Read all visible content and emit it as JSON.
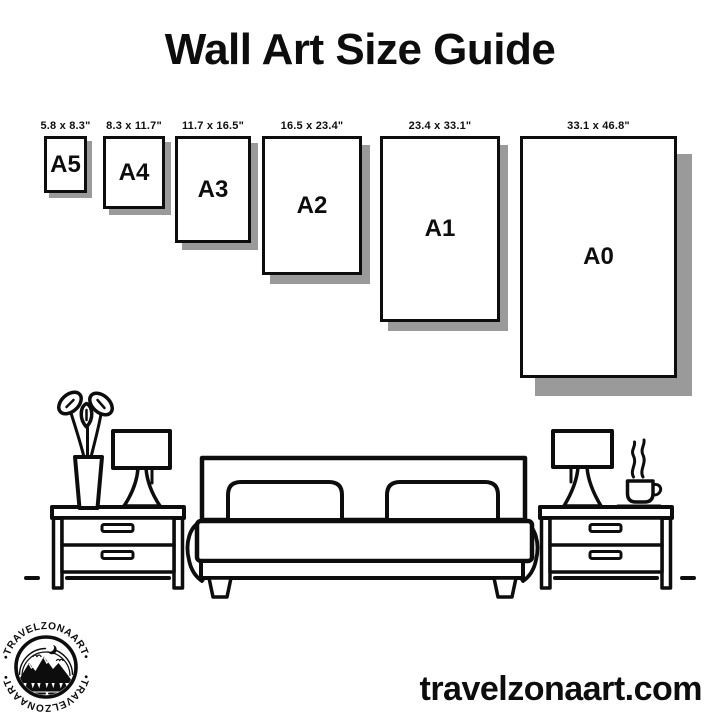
{
  "title": "Wall Art Size Guide",
  "papers": [
    {
      "code": "A5",
      "dims": "5.8 x 8.3\""
    },
    {
      "code": "A4",
      "dims": "8.3 x 11.7\""
    },
    {
      "code": "A3",
      "dims": "11.7 x 16.5\""
    },
    {
      "code": "A2",
      "dims": "16.5 x 23.4\""
    },
    {
      "code": "A1",
      "dims": "23.4 x 33.1\""
    },
    {
      "code": "A0",
      "dims": "33.1 x 46.8\""
    }
  ],
  "logo": {
    "brand": "TRAVELZONAART",
    "ring_top": "•TRAVELZONAART•",
    "ring_bottom": "•TRAVELZONAART•"
  },
  "website": "travelzonaart.com",
  "illustration_items": [
    "plant-vase",
    "table-lamp",
    "nightstand",
    "double-bed",
    "nightstand",
    "table-lamp",
    "coffee-cup"
  ],
  "colors": {
    "ink": "#0d0d0d",
    "paper_fill": "#ffffff",
    "paper_shadow": "#9a9a9a",
    "background": "#ffffff"
  }
}
